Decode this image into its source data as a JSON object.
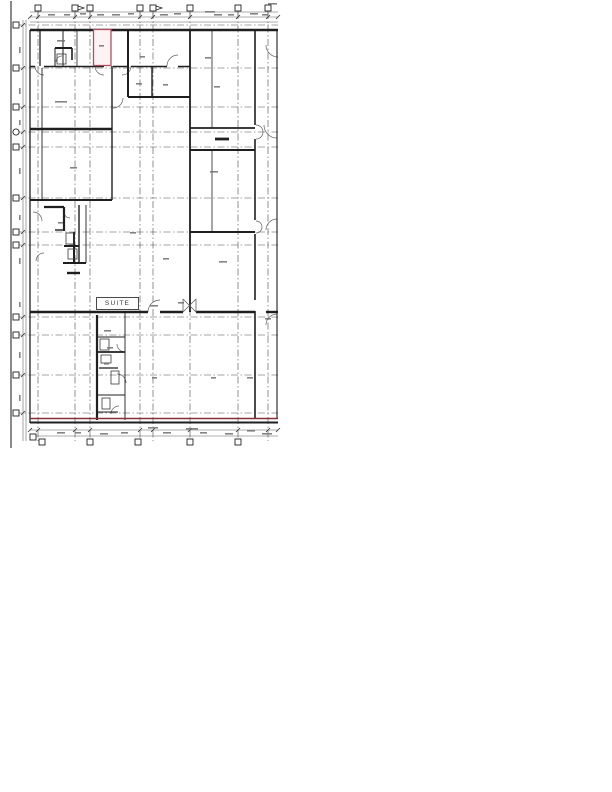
{
  "page": {
    "width": 612,
    "height": 792,
    "background": "#ffffff"
  },
  "drawing": {
    "type": "scanned-architectural-floor-plan",
    "suite_label": "SUITE",
    "colors": {
      "wall": "#1f1f1f",
      "grid": "#4a4a4a",
      "dim": "#5a5a5a",
      "arc": "#5f5f5f",
      "mark": "#6e6e6e",
      "marker_stroke": "#222222",
      "highlight_red": "#b14d63",
      "highlight_red_fill": "#fdf3f5",
      "wall_red": "#8a2f38",
      "trim": "#2b2b2b"
    },
    "trim_line": [
      11,
      1,
      11,
      448
    ],
    "grid": {
      "vertical_x": [
        38,
        75,
        90,
        140,
        153,
        190,
        238,
        268
      ],
      "horizontal_y": [
        25,
        68,
        107,
        132,
        147,
        198,
        232,
        245,
        317,
        335,
        375,
        413
      ],
      "top": 12,
      "bottom": 441,
      "left": 15,
      "right": 278,
      "dash": "7 2.5 1.5 2.5"
    },
    "markers": {
      "top": {
        "y": 8,
        "x": [
          38,
          75,
          90,
          140,
          153,
          190,
          238,
          268
        ],
        "flag_x": [
          75,
          153
        ]
      },
      "left": {
        "x": 16,
        "y": [
          25,
          68,
          107,
          147,
          198,
          232,
          245,
          317,
          335,
          375,
          413
        ],
        "circle_y": 132
      },
      "bottom": {
        "y": 442,
        "x": [
          42,
          90,
          138,
          190,
          238
        ]
      },
      "corner": {
        "x": 33,
        "y": 437
      },
      "size": 6
    },
    "dimension_lines": [
      [
        30,
        17,
        278,
        17
      ],
      [
        30,
        22,
        278,
        22
      ],
      [
        23,
        20,
        23,
        441
      ],
      [
        26,
        20,
        26,
        441
      ],
      [
        30,
        430,
        278,
        430
      ],
      [
        30,
        436,
        278,
        436
      ],
      [
        30,
        12,
        278,
        12
      ]
    ],
    "walls": [
      [
        30,
        30,
        278,
        30,
        2.6
      ],
      [
        30,
        30,
        30,
        423,
        1.3
      ],
      [
        30,
        66.5,
        35,
        66.5,
        1.5
      ],
      [
        44,
        66.5,
        104,
        66.5,
        1.5
      ],
      [
        113,
        66.5,
        128,
        66.5,
        1.5
      ],
      [
        131,
        66.5,
        167,
        66.5,
        1.5
      ],
      [
        178,
        66.5,
        190,
        66.5,
        1.5
      ],
      [
        40,
        30,
        40,
        66,
        1.3
      ],
      [
        63,
        30,
        63,
        66,
        1.0
      ],
      [
        77,
        30,
        77,
        66,
        0.8
      ],
      [
        128,
        30,
        128,
        97,
        2.0
      ],
      [
        152,
        66,
        152,
        97,
        1.4
      ],
      [
        128,
        97,
        190,
        97,
        2.0
      ],
      [
        190,
        30,
        190,
        312,
        1.8
      ],
      [
        212,
        30,
        212,
        128,
        0.8
      ],
      [
        212,
        150,
        212,
        232,
        0.8
      ],
      [
        255,
        30,
        255,
        125,
        1.6
      ],
      [
        255,
        139,
        255,
        220,
        1.6
      ],
      [
        255,
        234,
        255,
        300,
        1.6
      ],
      [
        255,
        311,
        255,
        418,
        1.6
      ],
      [
        277,
        30,
        277,
        418,
        1.1
      ],
      [
        30,
        129,
        112,
        129,
        2.4
      ],
      [
        190,
        128,
        255,
        128,
        1.8
      ],
      [
        190,
        150,
        255,
        150,
        2.0
      ],
      [
        215,
        139,
        229,
        139,
        2.8
      ],
      [
        42,
        68,
        42,
        200,
        0.9
      ],
      [
        112,
        66,
        112,
        200,
        1.4
      ],
      [
        30,
        200,
        112,
        200,
        2.0
      ],
      [
        55,
        48,
        72,
        48,
        2.0
      ],
      [
        72,
        48,
        72,
        60,
        1.6
      ],
      [
        55,
        48,
        55,
        66,
        1.0
      ],
      [
        44,
        207,
        64,
        207,
        2.2
      ],
      [
        64,
        207,
        64,
        231,
        2.2
      ],
      [
        55,
        230,
        64,
        230,
        1.4
      ],
      [
        79,
        205,
        79,
        264,
        1.4
      ],
      [
        64,
        246,
        79,
        246,
        2.0
      ],
      [
        74,
        232,
        74,
        262,
        2.0
      ],
      [
        63,
        263,
        86,
        263,
        2.0
      ],
      [
        67,
        273,
        80,
        273,
        2.4
      ],
      [
        86,
        205,
        86,
        263,
        0.9
      ],
      [
        190,
        232,
        255,
        232,
        2.0
      ],
      [
        30,
        312,
        148,
        312,
        2.4
      ],
      [
        160,
        312,
        183,
        312,
        2.4
      ],
      [
        196,
        312,
        255,
        312,
        2.4
      ],
      [
        266,
        312,
        278,
        312,
        2.4
      ],
      [
        97,
        315,
        97,
        420,
        2.2
      ],
      [
        125,
        312,
        125,
        420,
        0.9
      ],
      [
        97,
        337,
        125,
        337,
        0.9
      ],
      [
        97,
        352,
        125,
        352,
        1.8
      ],
      [
        99,
        368,
        118,
        368,
        1.2
      ],
      [
        97,
        395,
        125,
        395,
        0.9
      ],
      [
        97,
        412,
        118,
        412,
        0.9
      ],
      [
        30,
        422.5,
        278,
        422.5,
        2.0
      ]
    ],
    "red_room": {
      "x": 93.5,
      "y": 29.5,
      "w": 17.5,
      "h": 36
    },
    "red_line": [
      30,
      418.5,
      278,
      418.5,
      1.4
    ],
    "door_arcs": [
      [
        44,
        66,
        9,
        90,
        180
      ],
      [
        104,
        66,
        9,
        90,
        180
      ],
      [
        122,
        66,
        9,
        0,
        90
      ],
      [
        178,
        66,
        11,
        180,
        270
      ],
      [
        113,
        98,
        10,
        0,
        90
      ],
      [
        62,
        62,
        6,
        180,
        270
      ],
      [
        33,
        221,
        9,
        270,
        360
      ],
      [
        44,
        261,
        8,
        180,
        270
      ],
      [
        70,
        212,
        6,
        90,
        180
      ],
      [
        125,
        344,
        8,
        90,
        180
      ],
      [
        117,
        383,
        9,
        270,
        360
      ],
      [
        119,
        414,
        8,
        180,
        270
      ],
      [
        160,
        312,
        12,
        180,
        270
      ],
      [
        256,
        132,
        7,
        270,
        450
      ],
      [
        256,
        227,
        6,
        270,
        450
      ],
      [
        277,
        125,
        13,
        90,
        180
      ],
      [
        277,
        230,
        11,
        180,
        270
      ],
      [
        277,
        325,
        11,
        180,
        270
      ],
      [
        278,
        45,
        12,
        90,
        180
      ]
    ],
    "x_symbol": {
      "x1": 183,
      "y1": 299,
      "x2": 196,
      "y2": 312
    },
    "fixtures": [
      [
        100,
        339,
        9,
        11
      ],
      [
        101,
        355,
        10,
        8
      ],
      [
        111,
        371,
        8,
        13
      ],
      [
        102,
        398,
        8,
        11
      ],
      [
        66,
        233,
        8,
        11
      ],
      [
        68,
        249,
        9,
        10
      ],
      [
        57,
        54,
        9,
        10
      ]
    ],
    "illegible_marks": [
      [
        48,
        14,
        7,
        "h"
      ],
      [
        64,
        14,
        6,
        "h"
      ],
      [
        80,
        13,
        6,
        "h"
      ],
      [
        97,
        14,
        7,
        "h"
      ],
      [
        112,
        14,
        8,
        "h"
      ],
      [
        128,
        13,
        6,
        "h"
      ],
      [
        160,
        14,
        8,
        "h"
      ],
      [
        174,
        13,
        7,
        "h"
      ],
      [
        205,
        11,
        10,
        "h"
      ],
      [
        214,
        14,
        8,
        "h"
      ],
      [
        228,
        14,
        6,
        "h"
      ],
      [
        250,
        13,
        8,
        "h"
      ],
      [
        262,
        14,
        6,
        "h"
      ],
      [
        268,
        3,
        9,
        "h"
      ],
      [
        57,
        432,
        8,
        "h"
      ],
      [
        75,
        432,
        6,
        "h"
      ],
      [
        100,
        433,
        8,
        "h"
      ],
      [
        121,
        432,
        7,
        "h"
      ],
      [
        148,
        427,
        10,
        "h"
      ],
      [
        163,
        432,
        8,
        "h"
      ],
      [
        186,
        428,
        12,
        "h"
      ],
      [
        200,
        432,
        7,
        "h"
      ],
      [
        225,
        433,
        8,
        "h"
      ],
      [
        247,
        430,
        8,
        "h"
      ],
      [
        262,
        433,
        10,
        "h"
      ],
      [
        19,
        47,
        6,
        "v"
      ],
      [
        19,
        88,
        6,
        "v"
      ],
      [
        19,
        120,
        5,
        "v"
      ],
      [
        19,
        168,
        6,
        "v"
      ],
      [
        19,
        215,
        5,
        "v"
      ],
      [
        19,
        258,
        6,
        "v"
      ],
      [
        19,
        302,
        5,
        "v"
      ],
      [
        19,
        352,
        6,
        "v"
      ],
      [
        19,
        395,
        6,
        "v"
      ],
      [
        57,
        40,
        8,
        "h"
      ],
      [
        99,
        45,
        5,
        "h"
      ],
      [
        140,
        56,
        5,
        "h"
      ],
      [
        136,
        83,
        6,
        "h"
      ],
      [
        163,
        84,
        5,
        "h"
      ],
      [
        214,
        86,
        6,
        "h"
      ],
      [
        70,
        167,
        7,
        "h"
      ],
      [
        210,
        171,
        8,
        "h"
      ],
      [
        163,
        258,
        6,
        "h"
      ],
      [
        219,
        261,
        8,
        "h"
      ],
      [
        104,
        330,
        7,
        "h"
      ],
      [
        107,
        347,
        6,
        "h"
      ],
      [
        104,
        363,
        5,
        "h"
      ],
      [
        152,
        377,
        5,
        "h"
      ],
      [
        211,
        377,
        5,
        "h"
      ],
      [
        247,
        377,
        6,
        "h"
      ],
      [
        130,
        232,
        6,
        "h"
      ],
      [
        58,
        222,
        5,
        "h"
      ],
      [
        150,
        305,
        8,
        "h"
      ],
      [
        178,
        302,
        6,
        "h"
      ],
      [
        265,
        318,
        6,
        "h"
      ],
      [
        55,
        101,
        12,
        "h"
      ],
      [
        205,
        57,
        6,
        "h"
      ]
    ]
  }
}
